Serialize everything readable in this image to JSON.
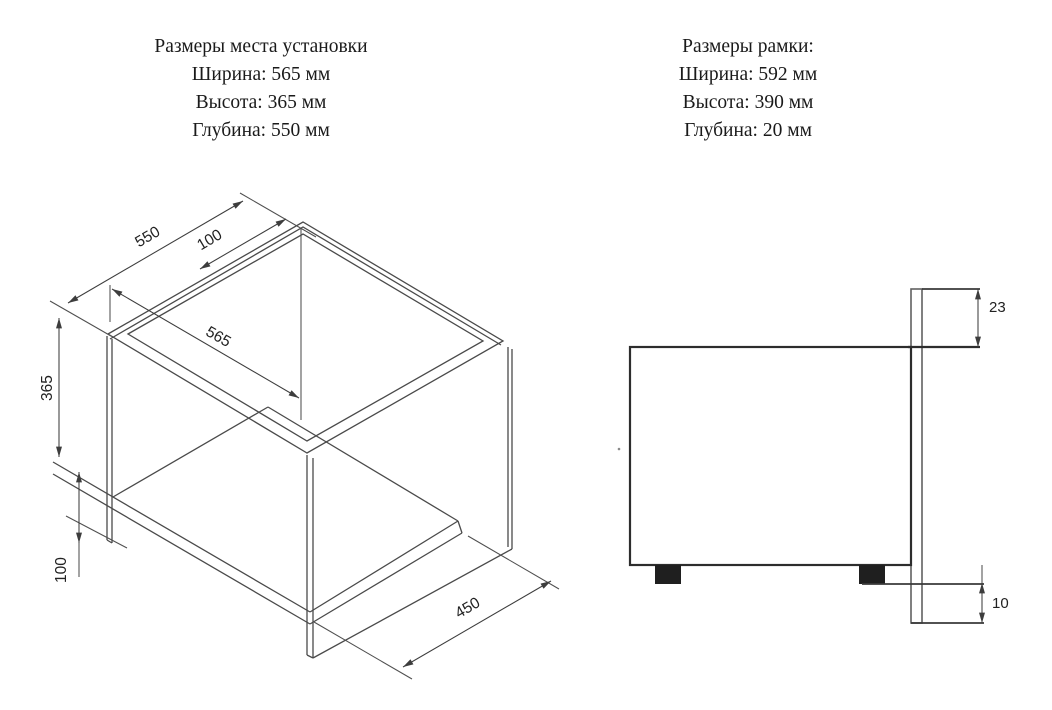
{
  "blocks": {
    "install": {
      "title": "Размеры места установки",
      "line1": "Ширина: 565 мм",
      "line2": "Высота: 365 мм",
      "line3": "Глубина: 550 мм"
    },
    "frame": {
      "title": "Размеры рамки:",
      "line1": "Ширина: 592 мм",
      "line2": "Высота: 390 мм",
      "line3": "Глубина: 20 мм"
    }
  },
  "iso_view": {
    "dim_depth": "550",
    "dim_back_offset": "100",
    "dim_width": "565",
    "dim_height": "365",
    "dim_shelf_drop": "100",
    "dim_shelf_depth": "450"
  },
  "side_view": {
    "dim_frame_top": "23",
    "dim_frame_bottom": "10"
  },
  "colors": {
    "line": "#4a4a4a",
    "heavy_line": "#2d2d2d",
    "text": "#1a1a1a",
    "foot_fill": "#1f1f1f",
    "background": "#ffffff"
  }
}
